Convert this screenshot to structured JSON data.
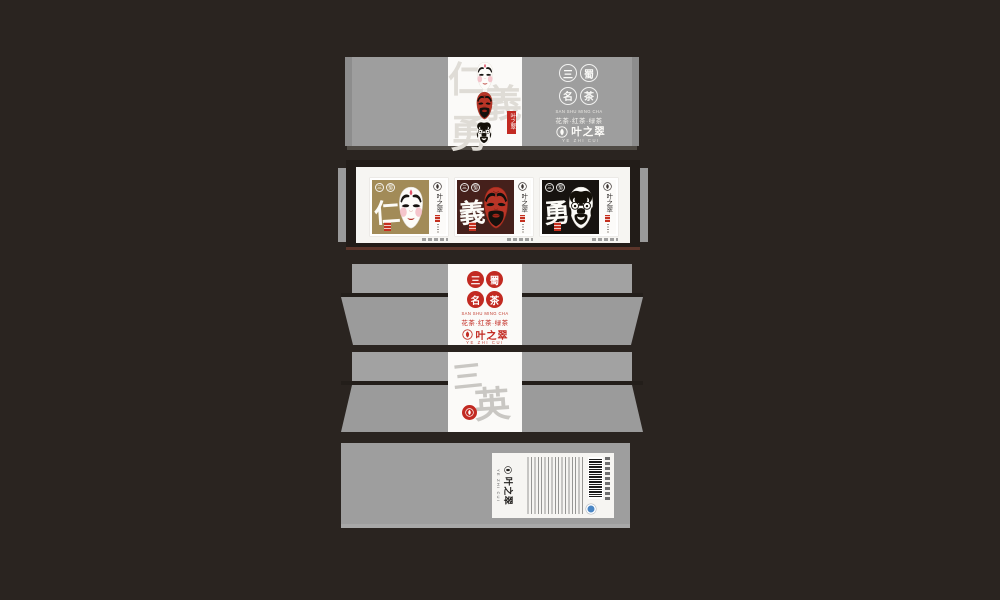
{
  "colors": {
    "background": "#2a2420",
    "panel_gray": "#9e9e9e",
    "accent_red": "#c22a22",
    "card_gold": "#a28b58",
    "card_maroon": "#45201b",
    "card_black": "#171310",
    "mask_red": "#b93527"
  },
  "brand": {
    "name": "叶之翠",
    "name_sub": "YE ZHI CUI",
    "series_name_chars": [
      "三",
      "蜀",
      "名",
      "茶"
    ],
    "series_en": "SAN SHU MING CHA",
    "series_cn": "花茶·红茶·绿茶"
  },
  "lid": {
    "watermark_chars": [
      "仁",
      "義",
      "勇"
    ]
  },
  "cards": [
    {
      "virtue": "仁",
      "mask": "liubei"
    },
    {
      "virtue": "義",
      "mask": "guanyu"
    },
    {
      "virtue": "勇",
      "mask": "zhangfei"
    }
  ],
  "card_seal_chars": [
    "三",
    "蜀"
  ],
  "front": {
    "watermark_chars": [
      "三",
      "英"
    ]
  },
  "icons": {
    "leaf_seal": "leaf-in-circle",
    "recycle": "recycle-mark",
    "barcode": "ean-barcode"
  }
}
